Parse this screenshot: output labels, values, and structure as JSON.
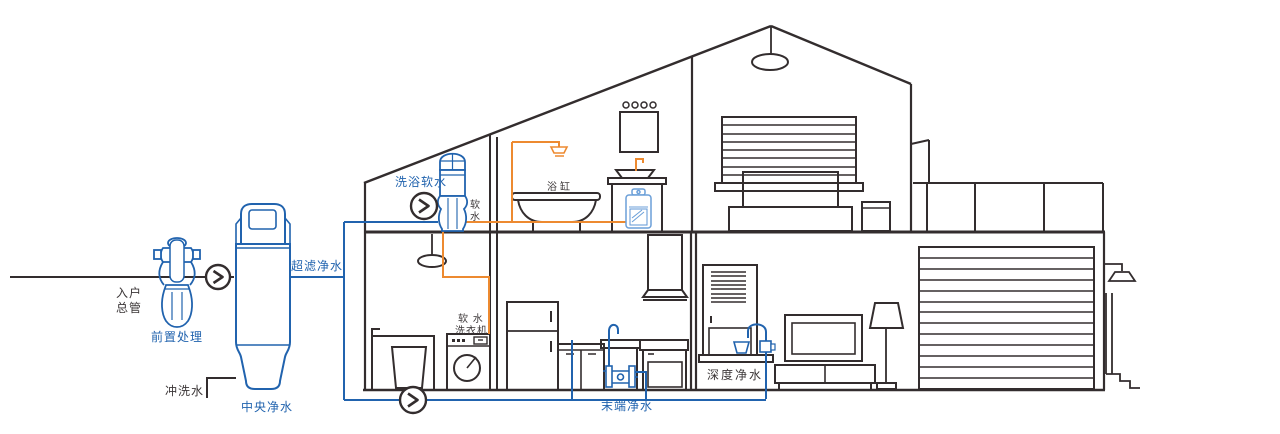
{
  "diagram": {
    "type": "whole-house water purification system cutaway",
    "background": "#ffffff"
  },
  "colors": {
    "line_dark": "#332d2e",
    "pipe_blue": "#2163ae",
    "pipe_orange": "#ed8a30",
    "text_dark": "#3b3637",
    "text_blue": "#2163ae"
  },
  "labels": {
    "inlet_line1": "入户",
    "inlet_line2": "总管",
    "pre_treatment": "前置处理",
    "flush_water": "冲洗水",
    "central_purifier": "中央净水",
    "ultrafiltration": "超滤净水",
    "bath_softener": "洗浴软水",
    "soft_water_char1": "软",
    "soft_water_char2": "水",
    "bathtub": "浴缸",
    "soft_washer_line1": "软 水",
    "soft_washer_line2": "洗衣机",
    "terminal_purifier": "末端净水",
    "deep_purifier": "深度净水"
  },
  "icons": {
    "flow_arrow": "circled chevron-right flow direction marker (3 instances)"
  }
}
